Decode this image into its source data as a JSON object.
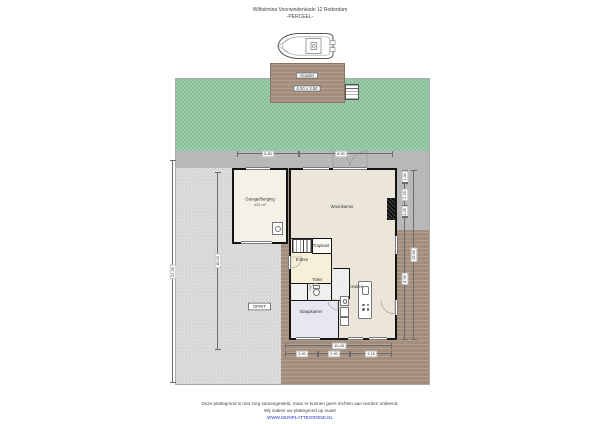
{
  "title": {
    "line1": "Wilhelmina Voorwindenkade 12 Rotterdam",
    "line2": "-PERCEEL-"
  },
  "site": {
    "dock_name": "Vlonder",
    "dock_size": "6.00 x 3.50",
    "driveway_label": "OPRIT"
  },
  "rooms": {
    "woonkamer": {
      "label": "Woonkamer"
    },
    "keuken": {
      "label": "Keuken"
    },
    "slaapkamer": {
      "label": "Slaapkamer"
    },
    "entree": {
      "label": "Entree"
    },
    "toilet": {
      "label": "Toilet"
    },
    "trapkast": {
      "label": "Trapkast"
    },
    "garage": {
      "label": "Garage/berging",
      "size": "±32 m²"
    }
  },
  "dimensions": {
    "top": [
      "5.80",
      "8.90"
    ],
    "bottom_total": "10.45",
    "bottom_segments": [
      "3.40",
      "2.90",
      "4.15"
    ],
    "right_segments": [
      "1.30",
      "2.25",
      "1.05",
      "8.95"
    ],
    "right_total": "13.55",
    "left_total": "21.30",
    "driveway_length": "18.00"
  },
  "footer": {
    "line1": "Deze plattegrond is met zorg samengesteld, maar er kunnen geen rechten aan worden ontleend.",
    "line2": "Wij maken uw plattegrond op maat!",
    "line3": "WWW.MIJNPLATTEGROND.NL"
  },
  "colors": {
    "garden": "#8fc6a0",
    "driveway": "#d9d9d9",
    "terrace": "#a38d7d",
    "wall": "#141414",
    "living_floor": "#ebe5da",
    "entree_floor": "#f6f0d8",
    "bedroom_floor": "#e8e6f0",
    "link": "#2233bb"
  }
}
